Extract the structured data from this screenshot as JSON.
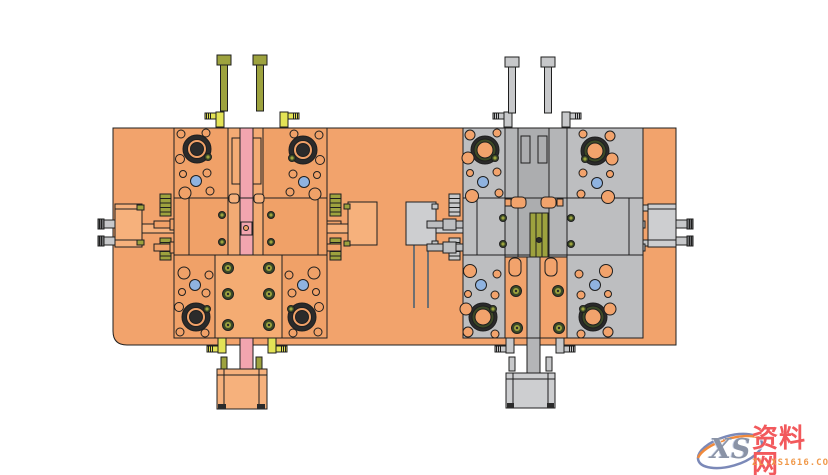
{
  "watermark": {
    "logo_text": "XS",
    "site_name": "资料网",
    "url": "ZL.XS1616.COM"
  },
  "colors": {
    "line": "#1f1f1f",
    "plate": "#F2A36C",
    "mold": "#F0A168",
    "mold_col": "#F3AB74",
    "mold_sub": "#F4AC73",
    "mold_light": "#F6B17C",
    "pink": "#F2A5AF",
    "olive": "#9DA23E",
    "ring_green": "#3C4A27",
    "yellow": "#E3E356",
    "gray_body": "#BDBEC0",
    "gray_col": "#B4B5B7",
    "gray_strip": "#ACADAF",
    "gray_light": "#CDCED0",
    "metal": "#C7C8CA",
    "metal_dark": "#6E6F71",
    "blue": "#8FB3E0",
    "dark": "#2B2B2B",
    "white": "#FFFFFF",
    "wm_red": "#F2595C",
    "wm_orange": "#F0994A",
    "wm_blue": "#7B89B8",
    "wm_swoosh": "#F08A3C",
    "wm_xs": "#8A93A6"
  },
  "components": [
    "base-plate",
    "cavity-mold-half-orange",
    "core-mold-half-grey",
    "guide-bushings",
    "cap-screws",
    "water-line-fittings",
    "latch-locks",
    "spring-plugs",
    "ejector-pin-rows",
    "center-sprue-strip",
    "bottom-clamp-blocks"
  ]
}
